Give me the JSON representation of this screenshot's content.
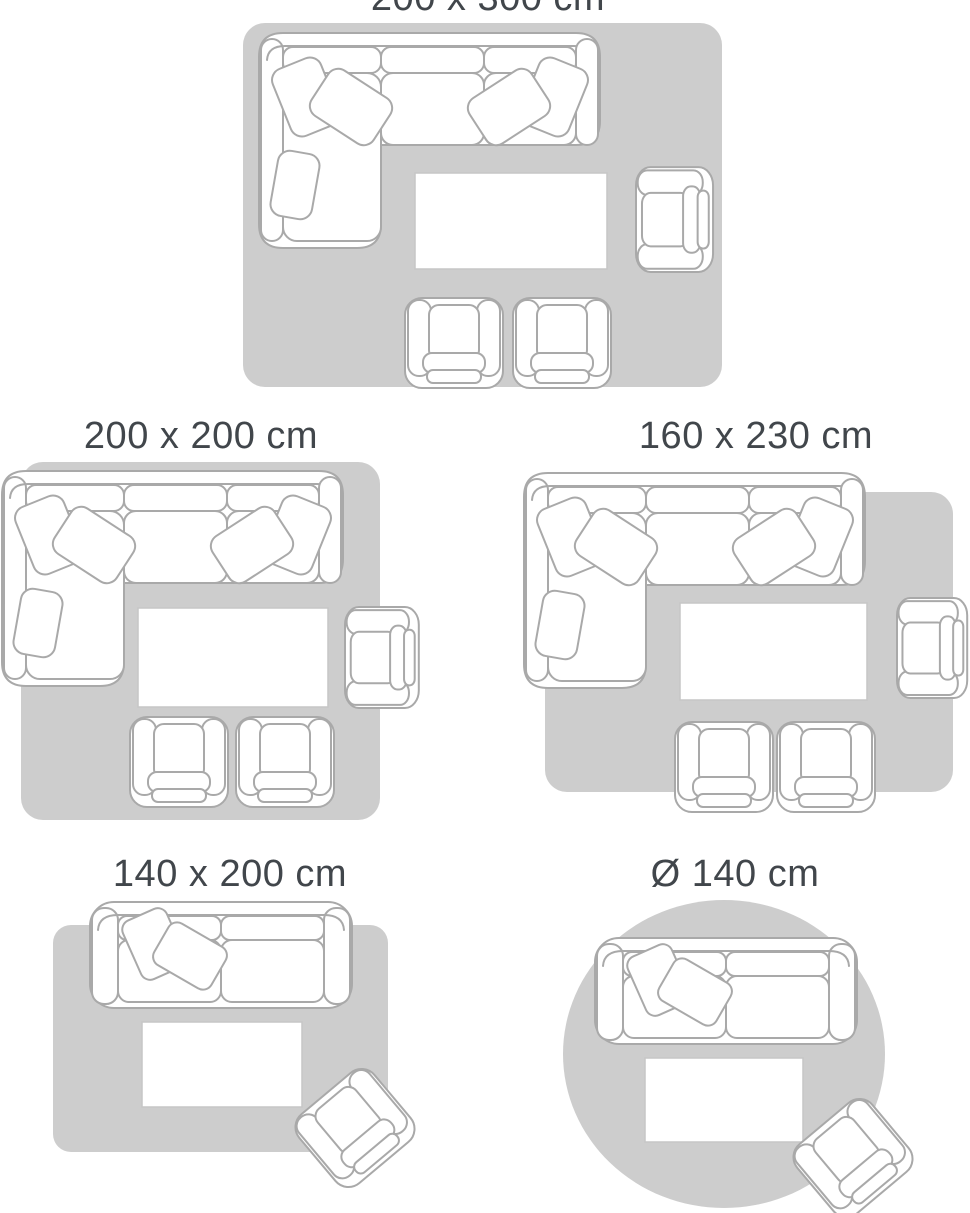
{
  "page": {
    "background": "#ffffff"
  },
  "colors": {
    "rug": "#cdcdcd",
    "furniture_fill": "#ffffff",
    "furniture_outline": "#a9a9a9",
    "table_outline": "#c6c6c6",
    "title_text": "#41464b"
  },
  "guide": {
    "sizes": [
      {
        "label": "200 x 300 cm",
        "shape": "rectangle"
      },
      {
        "label": "200 x 200 cm",
        "shape": "rectangle"
      },
      {
        "label": "160 x 230 cm",
        "shape": "rectangle"
      },
      {
        "label": "140 x 200 cm",
        "shape": "rectangle"
      },
      {
        "label": "Ø 140 cm",
        "shape": "circle"
      }
    ]
  }
}
